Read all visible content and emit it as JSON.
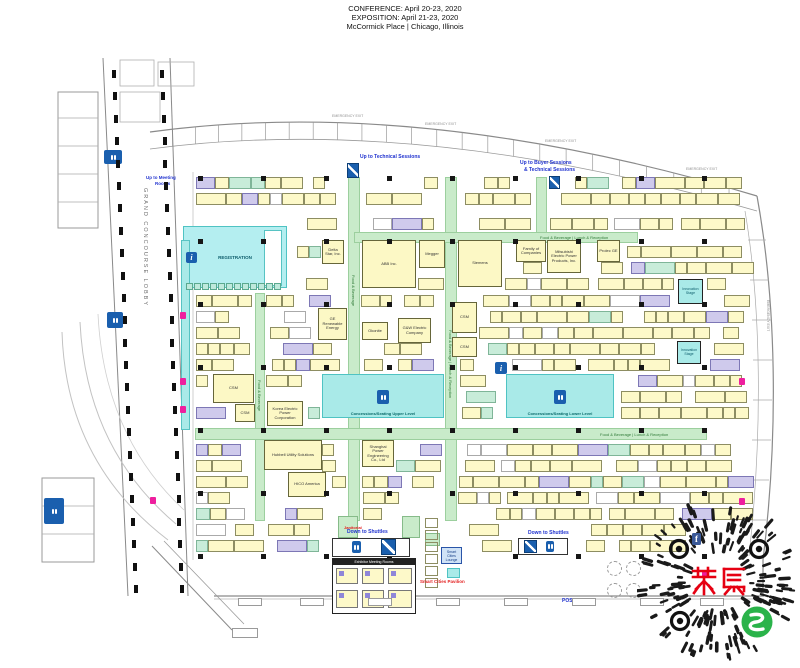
{
  "header": {
    "line1": "CONFERENCE: April 20-23, 2020",
    "line2": "EXPOSITION: April 21-23, 2020",
    "line3": "McCormick Place | Chicago, Illinois"
  },
  "labels": {
    "grand_concourse": "GRAND CONCOURSE LOBBY",
    "registration": "REGISTRATION",
    "concessions_upper": "Concessions/Seating Upper Level",
    "concessions_lower": "Concessions/Seating Lower Level",
    "up_technical": "Up to Technical Sessions",
    "up_buyer_1": "Up to Buyer Sessions",
    "up_buyer_2": "& Technical Sessions",
    "up_meeting_1": "Up to Meeting",
    "up_meeting_2": "Rooms",
    "down_shuttles": "Down to Shuttles",
    "smart_cities_pavilion": "Smart Cities Pavilion",
    "smart_cities_lounge": "Smart Cities Lounge",
    "exhibitor_meeting_rooms": "Exhibitor Meeting Rooms",
    "posters": "POSTERS",
    "janitorial": "Janitorial",
    "emergency_exit": "EMERGENCY EXIT",
    "innovation_stage": "Innovation Stage",
    "food_beverage": "Food & Beverage",
    "food_beverage_long": "Food & Beverage | Lunch & Reception",
    "info_glyph": "i"
  },
  "booths": [
    {
      "name": "Delta Star, Inc.",
      "rect": [
        322,
        240,
        22,
        24
      ]
    },
    {
      "name": "ABB Inc.",
      "rect": [
        362,
        240,
        54,
        48
      ]
    },
    {
      "name": "Megger",
      "rect": [
        419,
        240,
        26,
        28
      ]
    },
    {
      "name": "Siemens",
      "rect": [
        458,
        240,
        44,
        47
      ]
    },
    {
      "name": "Family of Companies",
      "rect": [
        516,
        240,
        30,
        22
      ]
    },
    {
      "name": "Mitsubishi Electric Power Products, Inc.",
      "rect": [
        547,
        240,
        34,
        33
      ]
    },
    {
      "name": "Prolec GE",
      "rect": [
        597,
        240,
        23,
        22
      ]
    },
    {
      "name": "GE Renewable Energy",
      "rect": [
        318,
        308,
        29,
        32
      ]
    },
    {
      "name": "Okonite",
      "rect": [
        362,
        322,
        26,
        18
      ]
    },
    {
      "name": "G&W Electric Company",
      "rect": [
        398,
        318,
        33,
        25
      ]
    },
    {
      "name": "CSM",
      "rect": [
        452,
        302,
        25,
        31
      ]
    },
    {
      "name": "CSM",
      "rect": [
        452,
        337,
        25,
        20
      ]
    },
    {
      "name": "CSM",
      "rect": [
        213,
        374,
        41,
        29
      ]
    },
    {
      "name": "CSM",
      "rect": [
        235,
        404,
        20,
        18
      ]
    },
    {
      "name": "Korea Electric Power Corporation",
      "rect": [
        267,
        401,
        36,
        25
      ]
    },
    {
      "name": "Hubbell Utility Solutions",
      "rect": [
        264,
        440,
        58,
        30
      ]
    },
    {
      "name": "HICO America",
      "rect": [
        288,
        472,
        38,
        25
      ]
    },
    {
      "name": "Shanghai Power Engineering Co., Ltd",
      "rect": [
        362,
        440,
        32,
        27
      ]
    }
  ],
  "watermark": {
    "text": "聚展",
    "text_color": "#e60012",
    "logo_color": "#2ab34a",
    "f_icon": "f"
  }
}
